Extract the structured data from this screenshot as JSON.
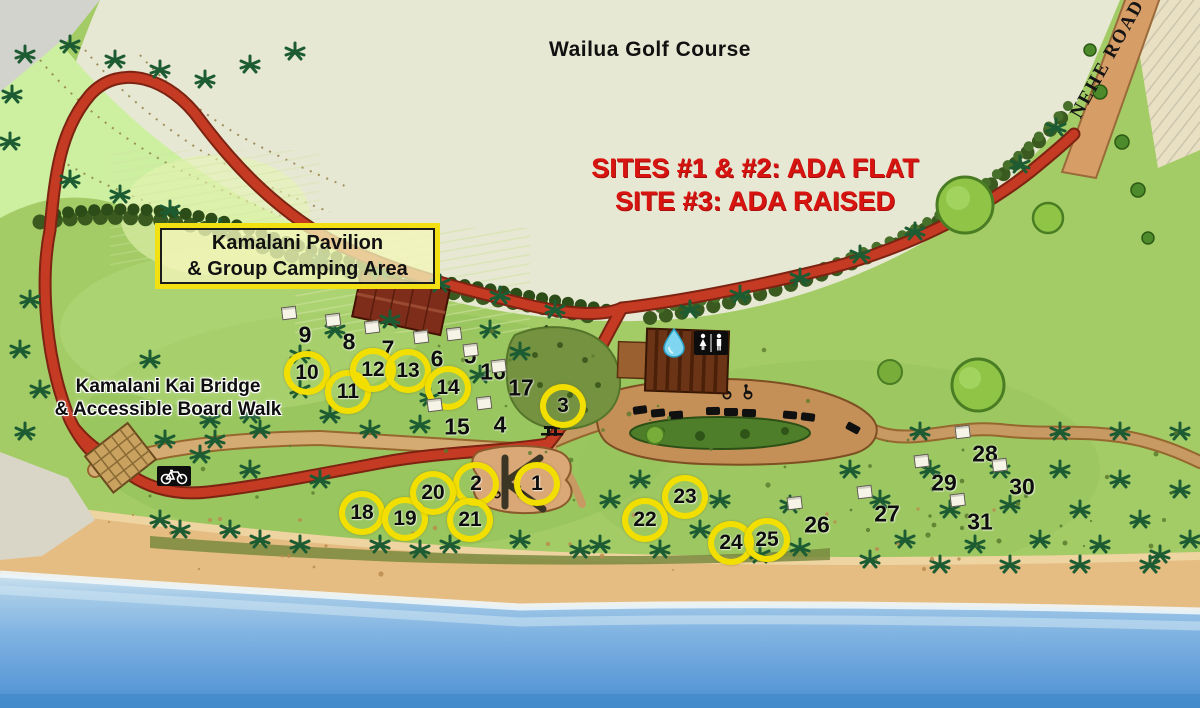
{
  "map": {
    "golf_label": "Wailua Golf Course",
    "ada_note_line1": "SITES #1 & #2: ADA FLAT",
    "ada_note_line2": "SITE #3: ADA RAISED",
    "pavilion_box_line1": "Kamalani Pavilion",
    "pavilion_box_line2": "& Group Camping Area",
    "bridge_label_line1": "Kamalani Kai Bridge",
    "bridge_label_line2": "& Accessible Board Walk",
    "road_label": "NEHE ROAD"
  },
  "colors": {
    "ada_text": "#d81410",
    "site_circle": "#f2df00",
    "box_border": "#f2e013",
    "red_road": "#c43a22",
    "dirt_road": "#c89a63",
    "ocean": "#6fabdf",
    "sand": "#e5bd82",
    "golf_field": "#e7e8d3"
  },
  "icons": [
    {
      "name": "restroom-icon"
    },
    {
      "name": "water-icon"
    },
    {
      "name": "bicycle-icon"
    },
    {
      "name": "accessible-icon"
    }
  ],
  "sites": [
    {
      "number": "1",
      "x": 537,
      "y": 484,
      "circled": true
    },
    {
      "number": "2",
      "x": 476,
      "y": 484,
      "circled": true
    },
    {
      "number": "3",
      "x": 563,
      "y": 406,
      "circled": true
    },
    {
      "number": "4",
      "x": 500,
      "y": 425,
      "circled": false
    },
    {
      "number": "5",
      "x": 470,
      "y": 356,
      "circled": false
    },
    {
      "number": "6",
      "x": 437,
      "y": 359,
      "circled": false
    },
    {
      "number": "7",
      "x": 388,
      "y": 349,
      "circled": false
    },
    {
      "number": "8",
      "x": 349,
      "y": 342,
      "circled": false
    },
    {
      "number": "9",
      "x": 305,
      "y": 335,
      "circled": false
    },
    {
      "number": "10",
      "x": 307,
      "y": 373,
      "circled": true
    },
    {
      "number": "11",
      "x": 348,
      "y": 392,
      "circled": true
    },
    {
      "number": "12",
      "x": 373,
      "y": 370,
      "circled": true
    },
    {
      "number": "13",
      "x": 408,
      "y": 371,
      "circled": true
    },
    {
      "number": "14",
      "x": 448,
      "y": 388,
      "circled": true
    },
    {
      "number": "15",
      "x": 457,
      "y": 427,
      "circled": false
    },
    {
      "number": "16",
      "x": 493,
      "y": 372,
      "circled": false
    },
    {
      "number": "17",
      "x": 521,
      "y": 388,
      "circled": false
    },
    {
      "number": "18",
      "x": 362,
      "y": 513,
      "circled": true
    },
    {
      "number": "19",
      "x": 405,
      "y": 519,
      "circled": true
    },
    {
      "number": "20",
      "x": 433,
      "y": 493,
      "circled": true
    },
    {
      "number": "21",
      "x": 470,
      "y": 520,
      "circled": true
    },
    {
      "number": "22",
      "x": 645,
      "y": 520,
      "circled": true
    },
    {
      "number": "23",
      "x": 685,
      "y": 497,
      "circled": true
    },
    {
      "number": "24",
      "x": 731,
      "y": 543,
      "circled": true
    },
    {
      "number": "25",
      "x": 767,
      "y": 540,
      "circled": true
    },
    {
      "number": "26",
      "x": 817,
      "y": 525,
      "circled": false
    },
    {
      "number": "27",
      "x": 887,
      "y": 514,
      "circled": false
    },
    {
      "number": "28",
      "x": 985,
      "y": 454,
      "circled": false
    },
    {
      "number": "29",
      "x": 944,
      "y": 483,
      "circled": false
    },
    {
      "number": "30",
      "x": 1022,
      "y": 487,
      "circled": false
    },
    {
      "number": "31",
      "x": 980,
      "y": 522,
      "circled": false
    }
  ]
}
